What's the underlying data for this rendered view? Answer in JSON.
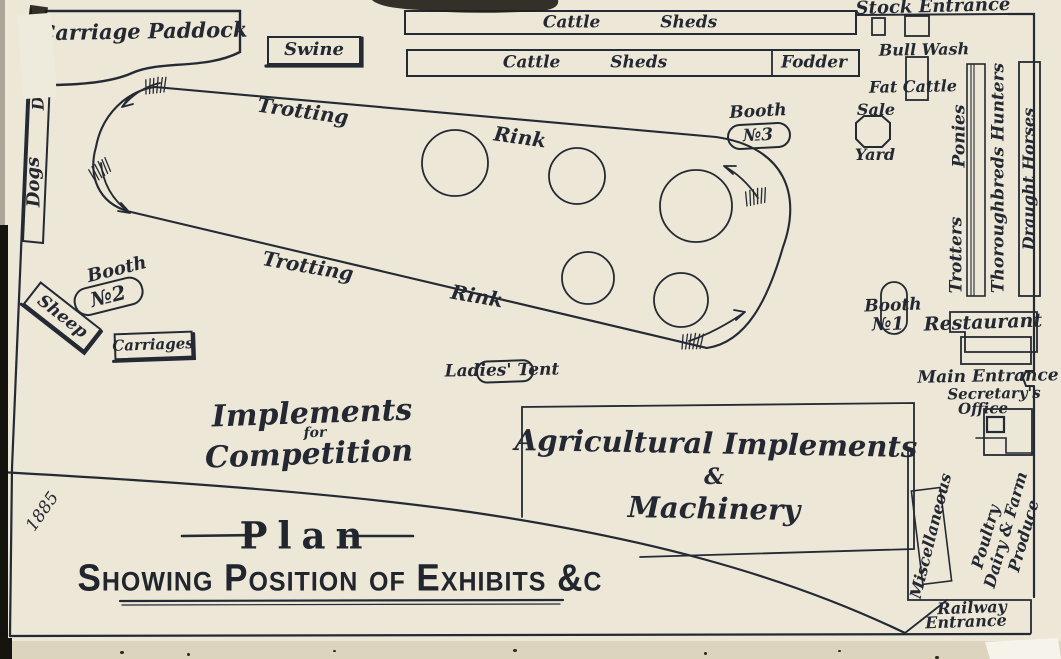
{
  "palette": {
    "paper": "#ece7d6",
    "paper_edge": "#ddd4bd",
    "ink": "#232833"
  },
  "title_block": {
    "title": "Plan",
    "subtitle": "Showing Position of Exhibits &c",
    "year_handwritten": "1885"
  },
  "track": {
    "trotting": "Trotting",
    "rink": "Rink",
    "ring_count": 4,
    "direction_arrows": 4
  },
  "areas": {
    "carriage_paddock": "Carriage Paddock",
    "swine": "Swine",
    "cattle_sheds_upper": "Cattle Sheds",
    "cattle_sheds_lower": "Cattle Sheds",
    "fodder": "Fodder",
    "stock_entrance": "Stock Entrance",
    "bull_wash": "Bull Wash",
    "fat_cattle": "Fat Cattle",
    "sale": "Sale",
    "yard": "Yard",
    "dogs": "Dogs",
    "sheep": "Sheep",
    "carriages": "Carriages",
    "ladies_tent": "Ladies' Tent",
    "implements_line1": "Implements",
    "implements_line2": "for",
    "implements_line3": "Competition",
    "agricultural_line1": "Agricultural Implements",
    "agricultural_line2": "&",
    "agricultural_line3": "Machinery",
    "restaurant": "Restaurant",
    "main_entrance": "Main Entrance",
    "secretarys": "Secretary's",
    "office": "Office",
    "ponies": "Ponies",
    "trotters": "Trotters",
    "thoroughbreds_hunters": "Thoroughbreds Hunters",
    "draught_horses": "Draught Horses",
    "miscellaneous": "Miscellaneous",
    "poultry_line1": "Poultry",
    "poultry_line2": "Dairy & Farm",
    "poultry_line3": "Produce",
    "railway_line1": "Railway",
    "railway_line2": "Entrance",
    "booth1_line1": "Booth",
    "booth1_line2": "№1",
    "booth2_line1": "Booth",
    "booth2_line2": "№2",
    "booth3_line1": "Booth",
    "booth3_line2": "№3"
  }
}
